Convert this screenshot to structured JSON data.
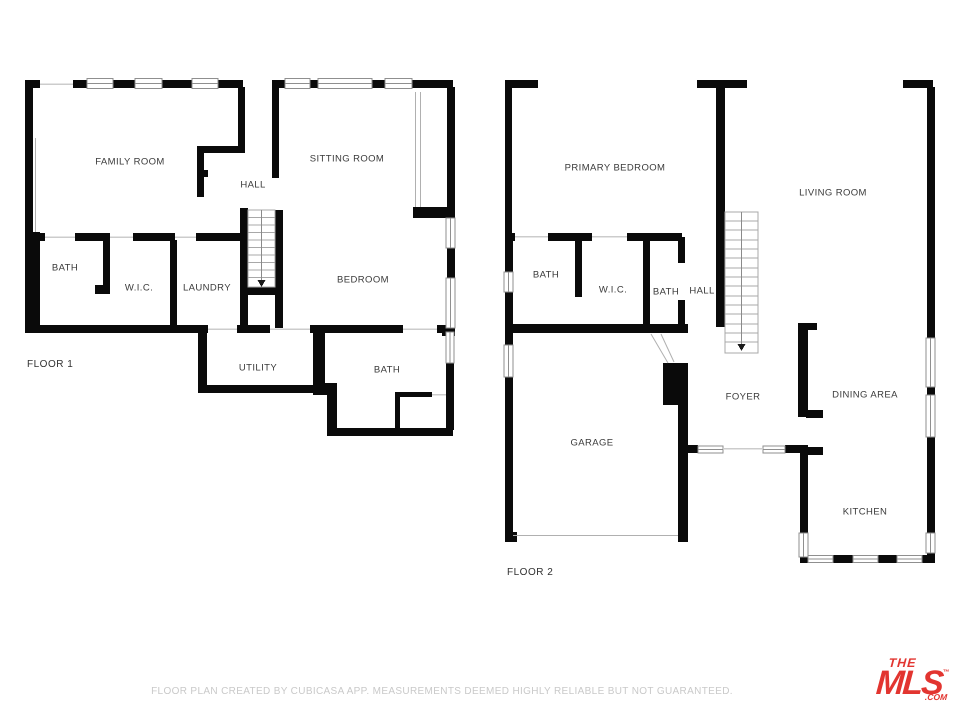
{
  "floor1": {
    "label": "FLOOR 1",
    "rooms": [
      {
        "label": "FAMILY ROOM"
      },
      {
        "label": "SITTING ROOM"
      },
      {
        "label": "HALL"
      },
      {
        "label": "BATH"
      },
      {
        "label": "W.I.C."
      },
      {
        "label": "LAUNDRY"
      },
      {
        "label": "BEDROOM"
      },
      {
        "label": "UTILITY"
      },
      {
        "label": "BATH"
      }
    ]
  },
  "floor2": {
    "label": "FLOOR 2",
    "rooms": [
      {
        "label": "PRIMARY BEDROOM"
      },
      {
        "label": "LIVING ROOM"
      },
      {
        "label": "BATH"
      },
      {
        "label": "W.I.C."
      },
      {
        "label": "BATH"
      },
      {
        "label": "HALL"
      },
      {
        "label": "FOYER"
      },
      {
        "label": "DINING AREA"
      },
      {
        "label": "GARAGE"
      },
      {
        "label": "KITCHEN"
      }
    ]
  },
  "footer": {
    "disclaimer": "FLOOR PLAN CREATED BY CUBICASA APP. MEASUREMENTS DEEMED HIGHLY RELIABLE BUT NOT GUARANTEED."
  },
  "logo": {
    "line1": "THE",
    "line2": "MLS",
    "trademark": "™",
    "suffix": ".COM",
    "color": "#e23530"
  },
  "colors": {
    "wall": "#0a0a0a",
    "room_label": "#3a3a3a",
    "floor_label": "#303030",
    "disclaimer": "#c9c9c9",
    "window_stroke": "#8f8f8f",
    "stair_stroke": "#a8a8a8",
    "door_line": "#cccccc",
    "thin_line": "#b0b0b0"
  }
}
